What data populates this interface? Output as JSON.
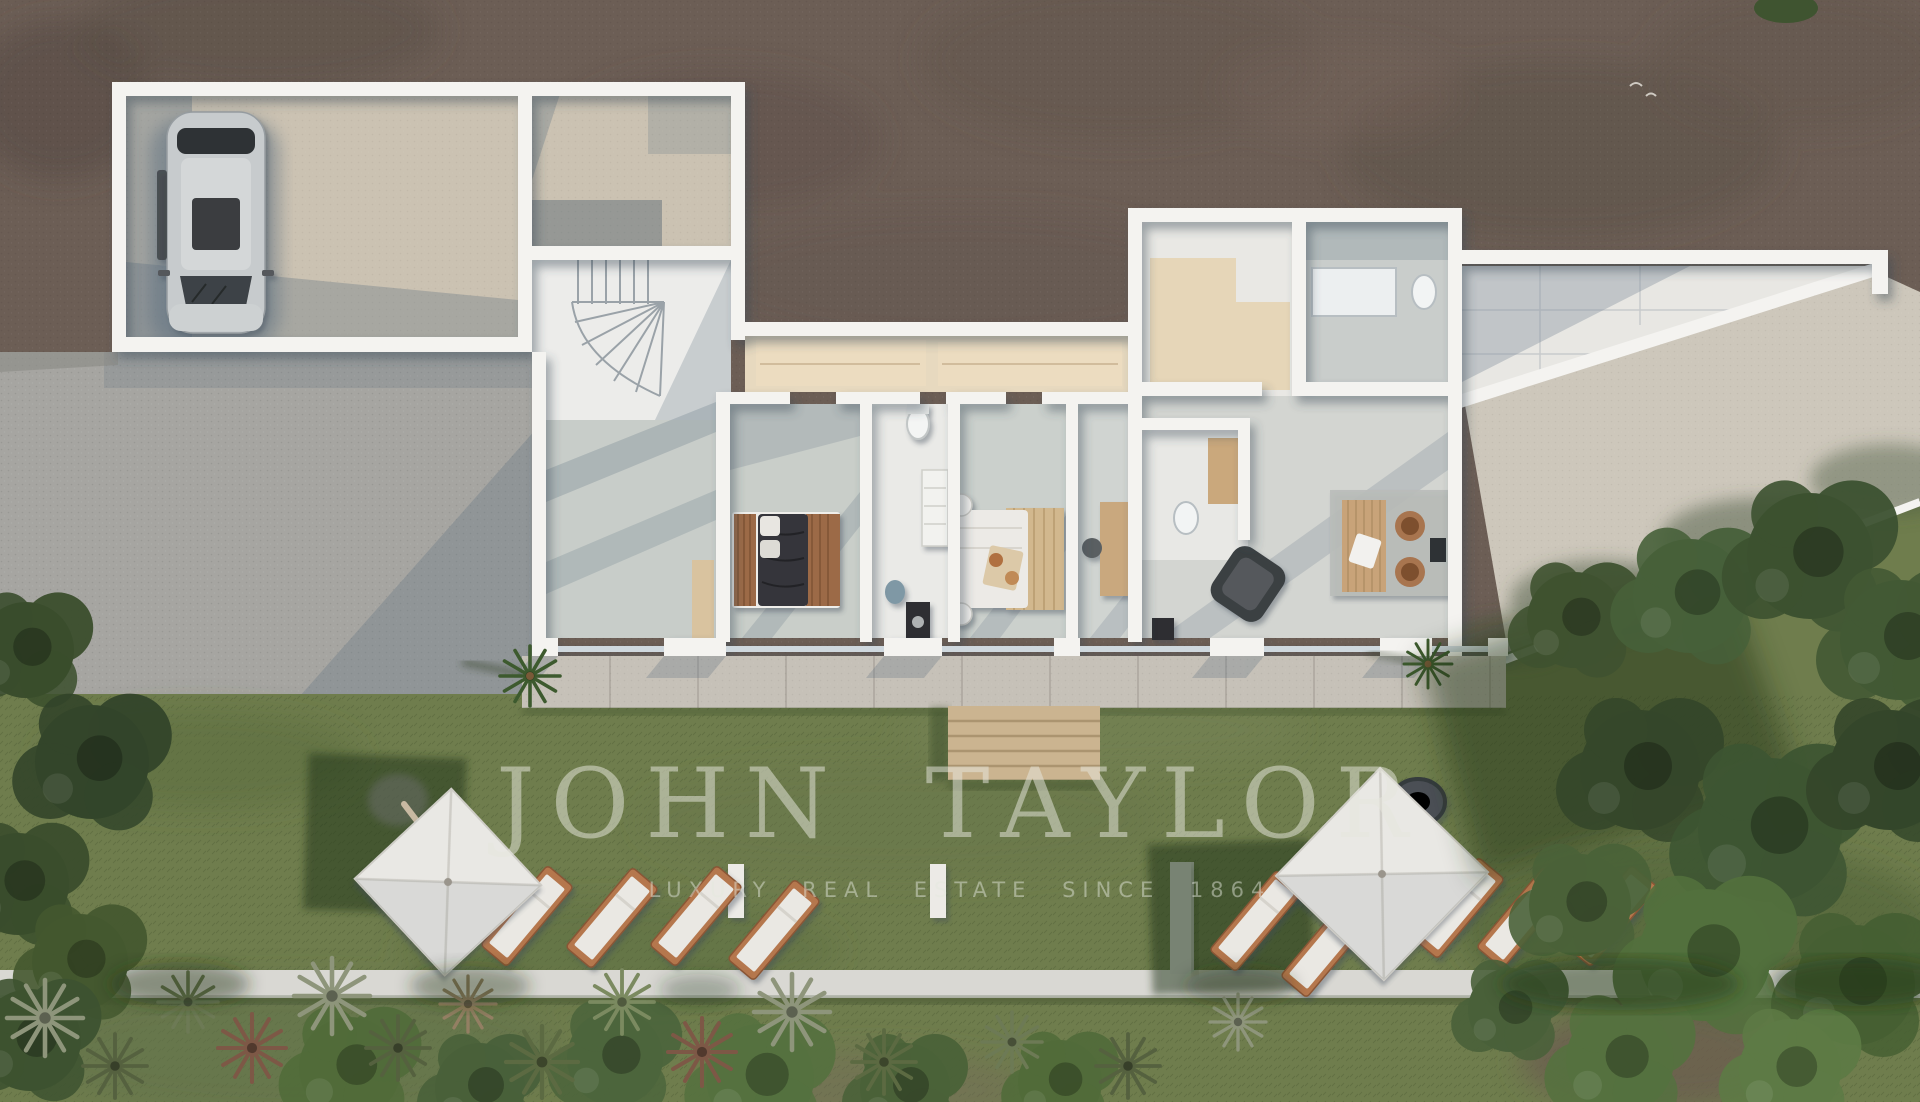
{
  "watermark": {
    "brand": "JOHN TAYLOR",
    "tagline": "LUXURY REAL ESTATE SINCE 1864",
    "color": "#e6e7dd"
  },
  "palette": {
    "dirt": "#6c5e55",
    "dirt_dark": "#594d46",
    "gravel": "#a6a5a1",
    "grass": "#6f7d4d",
    "grass_shadow": "#3c4f2c",
    "concrete_court": "#cbc2b2",
    "wall_white": "#f4f3f0",
    "tile_gray": "#c9cec9",
    "travertine": "#e7d9bf",
    "terrace": "#c6c1b8",
    "terrace_right": "#cdc7bb",
    "deck_wood": "#cbb490",
    "lounger_wood": "#b5774e",
    "cushion": "#eae8e3",
    "canopy": "#e9e8e4",
    "car_silver": "#c7cbcd",
    "tree_dark": "#3c5130",
    "path": "#d9d8d3"
  },
  "scene": {
    "type": "aerial-3d-floorplan-render",
    "counts": {
      "parasols": 2,
      "sun_loungers": 9,
      "cars": 1,
      "palm_trees": 2,
      "beds": 2
    }
  }
}
